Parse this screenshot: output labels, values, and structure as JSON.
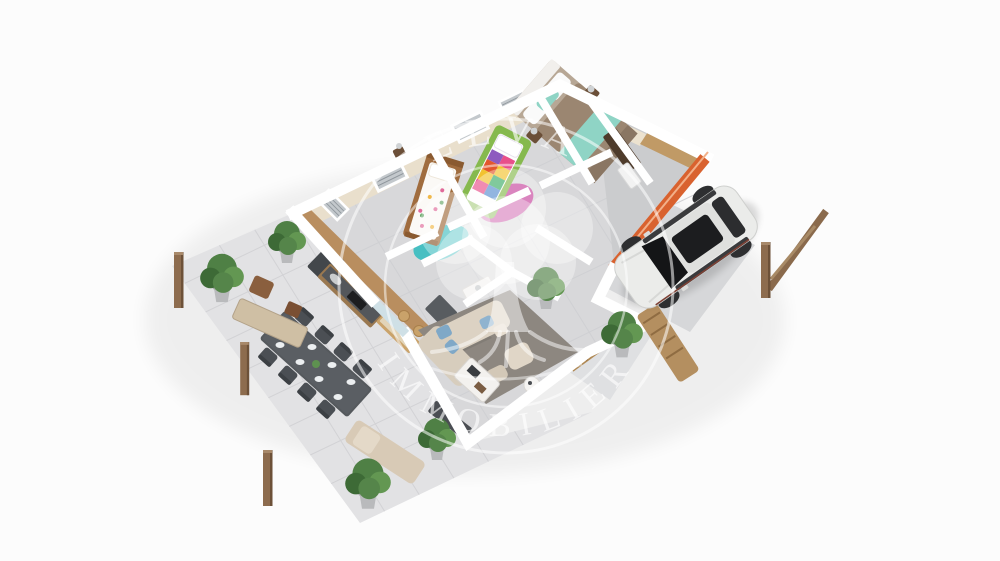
{
  "image": {
    "kind": "3d-isometric-floor-plan-render",
    "background": "#fcfcfc",
    "description": "Aerial 3D cutaway floor plan of a single-storey house with furnished bedrooms, bathroom, kitchen, living room, outdoor dining terrace, loungers, pergola posts, carport with white SUV, and a translucent real-estate watermark logo"
  },
  "watermark": {
    "brand": "ELVA",
    "tagline": "IMMOBILIER",
    "icon": "tree-with-roots-in-double-circle",
    "style": "translucent white"
  },
  "palette": {
    "accent-orange": "#d9622f",
    "rug-teal": "#47bfc2",
    "rug-pink": "#c7469f",
    "bed-green": "#86b94e",
    "sofa-cream": "#dcd2c3",
    "car-white": "#ebecea",
    "plant-green": "#4f8045",
    "terrace-gray": "#e2e2e4",
    "floor-gray": "#d8d8da",
    "wood": "#b98e5f",
    "dining-charcoal": "#55595d",
    "duvet-taupe": "#9b8671",
    "throw-teal": "#8fd4c5",
    "wall-white": "#ffffff",
    "post-brown": "#8d6c4e"
  },
  "scene_objects": [
    "master-bedroom-double-bed",
    "kids-bedroom-green-bed",
    "kids-bedroom-wood-bed",
    "bathroom",
    "kitchen",
    "living-room-sofa",
    "outdoor-dining-set",
    "sun-loungers",
    "potted-plants",
    "pergola-posts",
    "white-suv-on-driveway",
    "orange-accent-wall"
  ]
}
